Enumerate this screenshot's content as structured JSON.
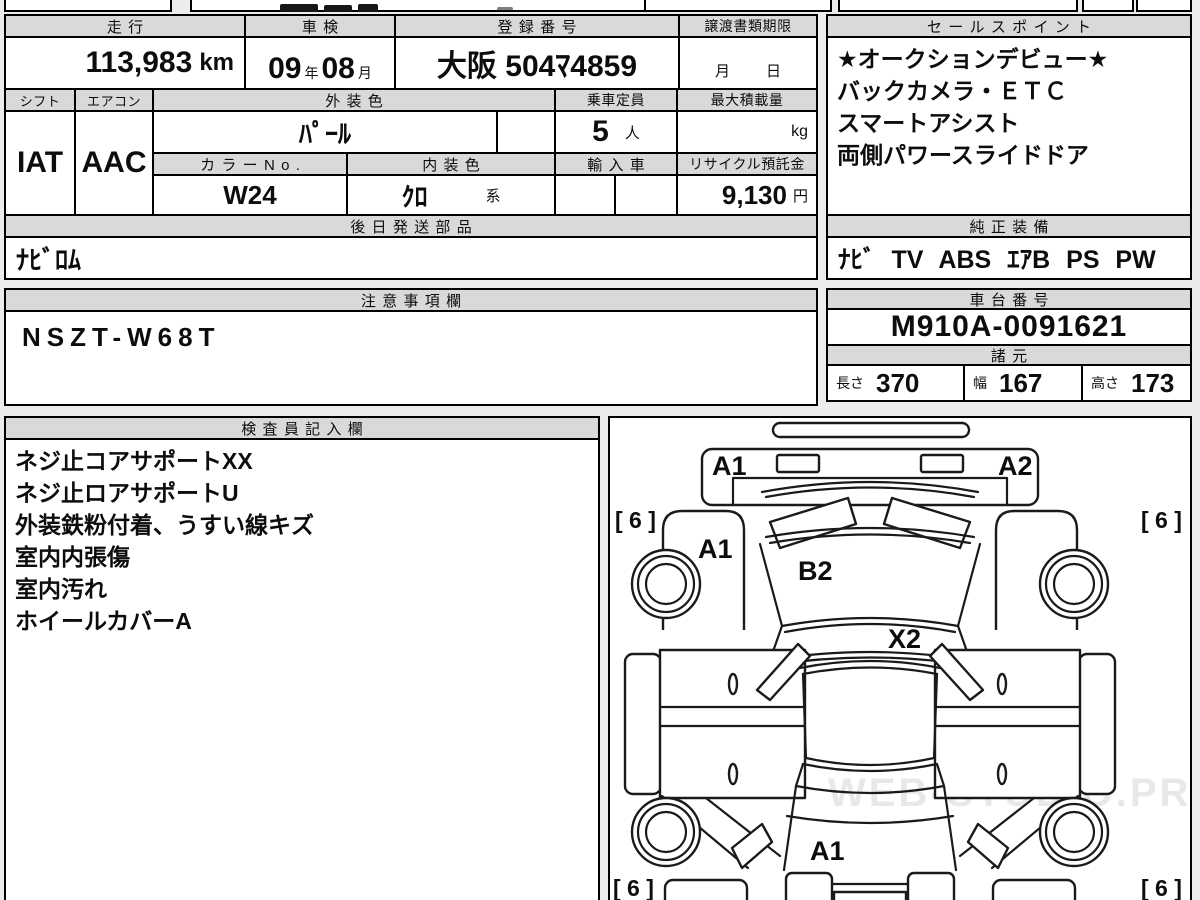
{
  "vehicle": {
    "mileage": {
      "label": "走行",
      "value": "113,983",
      "unit": "km"
    },
    "inspection": {
      "label": "車検",
      "year": "09",
      "year_suffix": "年",
      "month": "08",
      "month_suffix": "月"
    },
    "registration": {
      "label": "登録番号",
      "value": "大阪 504ﾏ4859"
    },
    "transfer_deadline": {
      "label": "譲渡書類期限",
      "month_suffix": "月",
      "day_suffix": "日"
    },
    "shift": {
      "label": "シフト",
      "value": "IAT"
    },
    "aircon": {
      "label": "エアコン",
      "value": "AAC"
    },
    "exterior_color": {
      "label": "外装色",
      "value": "ﾊﾟｰﾙ"
    },
    "capacity": {
      "label": "乗車定員",
      "value": "5",
      "unit": "人"
    },
    "max_load": {
      "label": "最大積載量",
      "unit": "kg"
    },
    "color_no": {
      "label": "カラーNo.",
      "value": "W24"
    },
    "interior_color": {
      "label": "内装色",
      "value": "ｸﾛ",
      "suffix": "系"
    },
    "imported": {
      "label": "輸入車"
    },
    "recycle_deposit": {
      "label": "リサイクル預託金",
      "value": "9,130",
      "unit": "円"
    },
    "later_shipped_parts": {
      "label": "後日発送部品",
      "value": "ﾅﾋﾞﾛﾑ"
    }
  },
  "sales_points": {
    "label": "セールスポイント",
    "lines": [
      "★オークションデビュー★",
      "バックカメラ・ＥＴＣ",
      "スマートアシスト",
      "両側パワースライドドア"
    ]
  },
  "genuine_equipment": {
    "label": "純正装備",
    "value": "ﾅﾋﾞ TV ABS ｴｱB PS PW"
  },
  "cautions": {
    "label": "注意事項欄",
    "value": "NSZT-W68T"
  },
  "chassis_number": {
    "label": "車台番号",
    "value": "M910A-0091621"
  },
  "specs": {
    "label": "諸元",
    "length_label": "長さ",
    "length_value": "370",
    "width_label": "幅",
    "width_value": "167",
    "height_label": "高さ",
    "height_value": "173"
  },
  "inspector_notes": {
    "label": "検査員記入欄",
    "lines": [
      "ネジ止コアサポートXX",
      "ネジ止ロアサポートU",
      "外装鉄粉付着、うすい線キズ",
      "室内内張傷",
      "室内汚れ",
      "ホイールカバーA"
    ]
  },
  "diagram": {
    "front_left_corner": "A1",
    "front_right_corner": "A2",
    "left_fender": "A1",
    "hood": "B2",
    "cowl": "X2",
    "rear": "A1",
    "tire_front_left": "[ 6 ]",
    "tire_front_right": "[ 6 ]",
    "tire_rear_left": "[ 6 ]",
    "tire_rear_right": "[ 6 ]",
    "watermark": "WEB-STUDIO.PRO"
  }
}
